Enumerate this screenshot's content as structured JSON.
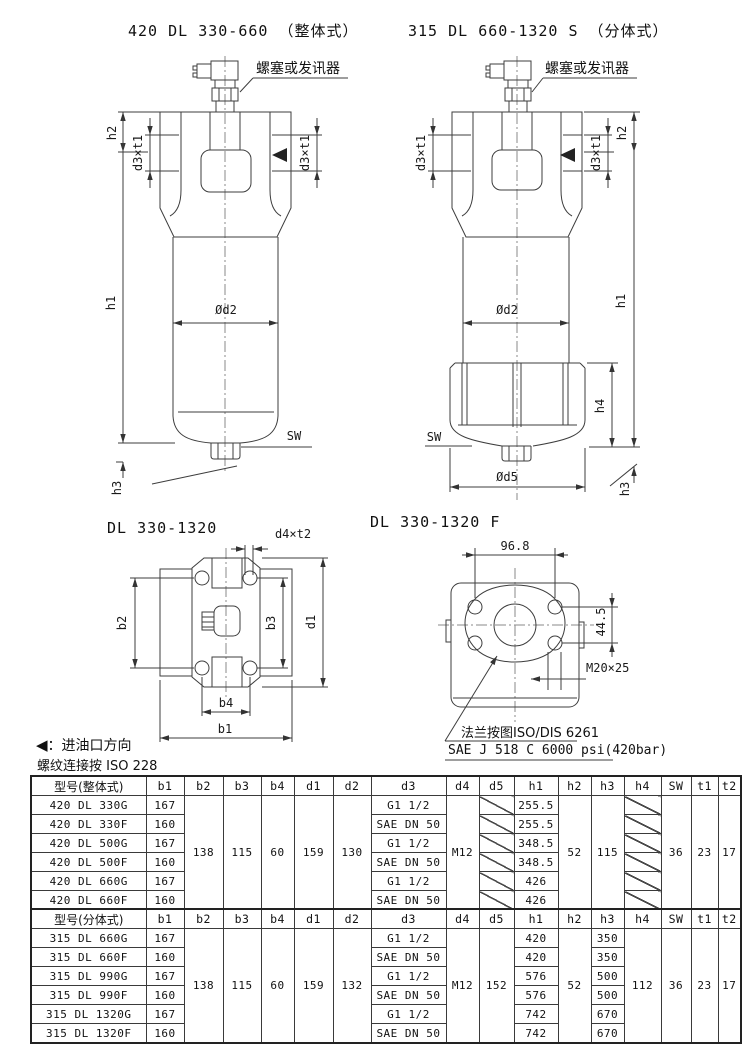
{
  "views": {
    "integral": {
      "title": "420 DL 330-660 （整体式）",
      "plug_label": "螺塞或发讯器"
    },
    "split": {
      "title": "315 DL 660-1320 S （分体式）",
      "plug_label": "螺塞或发讯器"
    },
    "bottom": {
      "title": "DL 330-1320"
    },
    "flange": {
      "title": "DL 330-1320 F",
      "dim_width": "96.8",
      "dim_height": "44.5",
      "thread": "M20×25",
      "note1": "法兰按图ISO/DIS 6261",
      "note2": "SAE J 518 C 6000 psi(420bar)"
    }
  },
  "labels": {
    "h1": "h1",
    "h2": "h2",
    "h3": "h3",
    "h4": "h4",
    "od2": "Ød2",
    "od5": "Ød5",
    "sw": "SW",
    "d3t1": "d3×t1",
    "d4t2": "d4×t2",
    "b1": "b1",
    "b2": "b2",
    "b3": "b3",
    "b4": "b4",
    "d1": "d1"
  },
  "legend": {
    "arrow": "◀",
    "inlet_note": "：进油口方向",
    "thread_note": "螺纹连接按 ISO 228"
  },
  "tables": [
    {
      "headers": [
        "型号(整体式)",
        "b1",
        "b2",
        "b3",
        "b4",
        "d1",
        "d2",
        "d3",
        "d4",
        "d5",
        "h1",
        "h2",
        "h3",
        "h4",
        "SW",
        "t1",
        "t2"
      ],
      "merged": {
        "b2": "138",
        "b3": "115",
        "b4": "60",
        "d1": "159",
        "d2": "130",
        "d4": "M12",
        "h2": "52",
        "h3": "115",
        "sw": "36",
        "t1": "23",
        "t2": "17"
      },
      "rows": [
        {
          "model": "420 DL 330G",
          "b1": "167",
          "d3": "G1 1/2",
          "h1": "255.5"
        },
        {
          "model": "420 DL 330F",
          "b1": "160",
          "d3": "SAE DN 50",
          "h1": "255.5"
        },
        {
          "model": "420 DL 500G",
          "b1": "167",
          "d3": "G1 1/2",
          "h1": "348.5"
        },
        {
          "model": "420 DL 500F",
          "b1": "160",
          "d3": "SAE DN 50",
          "h1": "348.5"
        },
        {
          "model": "420 DL 660G",
          "b1": "167",
          "d3": "G1 1/2",
          "h1": "426"
        },
        {
          "model": "420 DL 660F",
          "b1": "160",
          "d3": "SAE DN 50",
          "h1": "426"
        }
      ]
    },
    {
      "headers": [
        "型号(分体式)",
        "b1",
        "b2",
        "b3",
        "b4",
        "d1",
        "d2",
        "d3",
        "d4",
        "d5",
        "h1",
        "h2",
        "h3",
        "h4",
        "SW",
        "t1",
        "t2"
      ],
      "merged": {
        "b2": "138",
        "b3": "115",
        "b4": "60",
        "d1": "159",
        "d2": "132",
        "d4": "M12",
        "d5": "152",
        "h2": "52",
        "h4": "112",
        "sw": "36",
        "t1": "23",
        "t2": "17"
      },
      "rows": [
        {
          "model": "315 DL 660G",
          "b1": "167",
          "d3": "G1 1/2",
          "h1": "420",
          "h3": "350"
        },
        {
          "model": "315 DL 660F",
          "b1": "160",
          "d3": "SAE DN 50",
          "h1": "420",
          "h3": "350"
        },
        {
          "model": "315 DL 990G",
          "b1": "167",
          "d3": "G1 1/2",
          "h1": "576",
          "h3": "500"
        },
        {
          "model": "315 DL 990F",
          "b1": "160",
          "d3": "SAE DN 50",
          "h1": "576",
          "h3": "500"
        },
        {
          "model": "315 DL 1320G",
          "b1": "167",
          "d3": "G1 1/2",
          "h1": "742",
          "h3": "670"
        },
        {
          "model": "315 DL 1320F",
          "b1": "160",
          "d3": "SAE DN 50",
          "h1": "742",
          "h3": "670"
        }
      ]
    }
  ]
}
